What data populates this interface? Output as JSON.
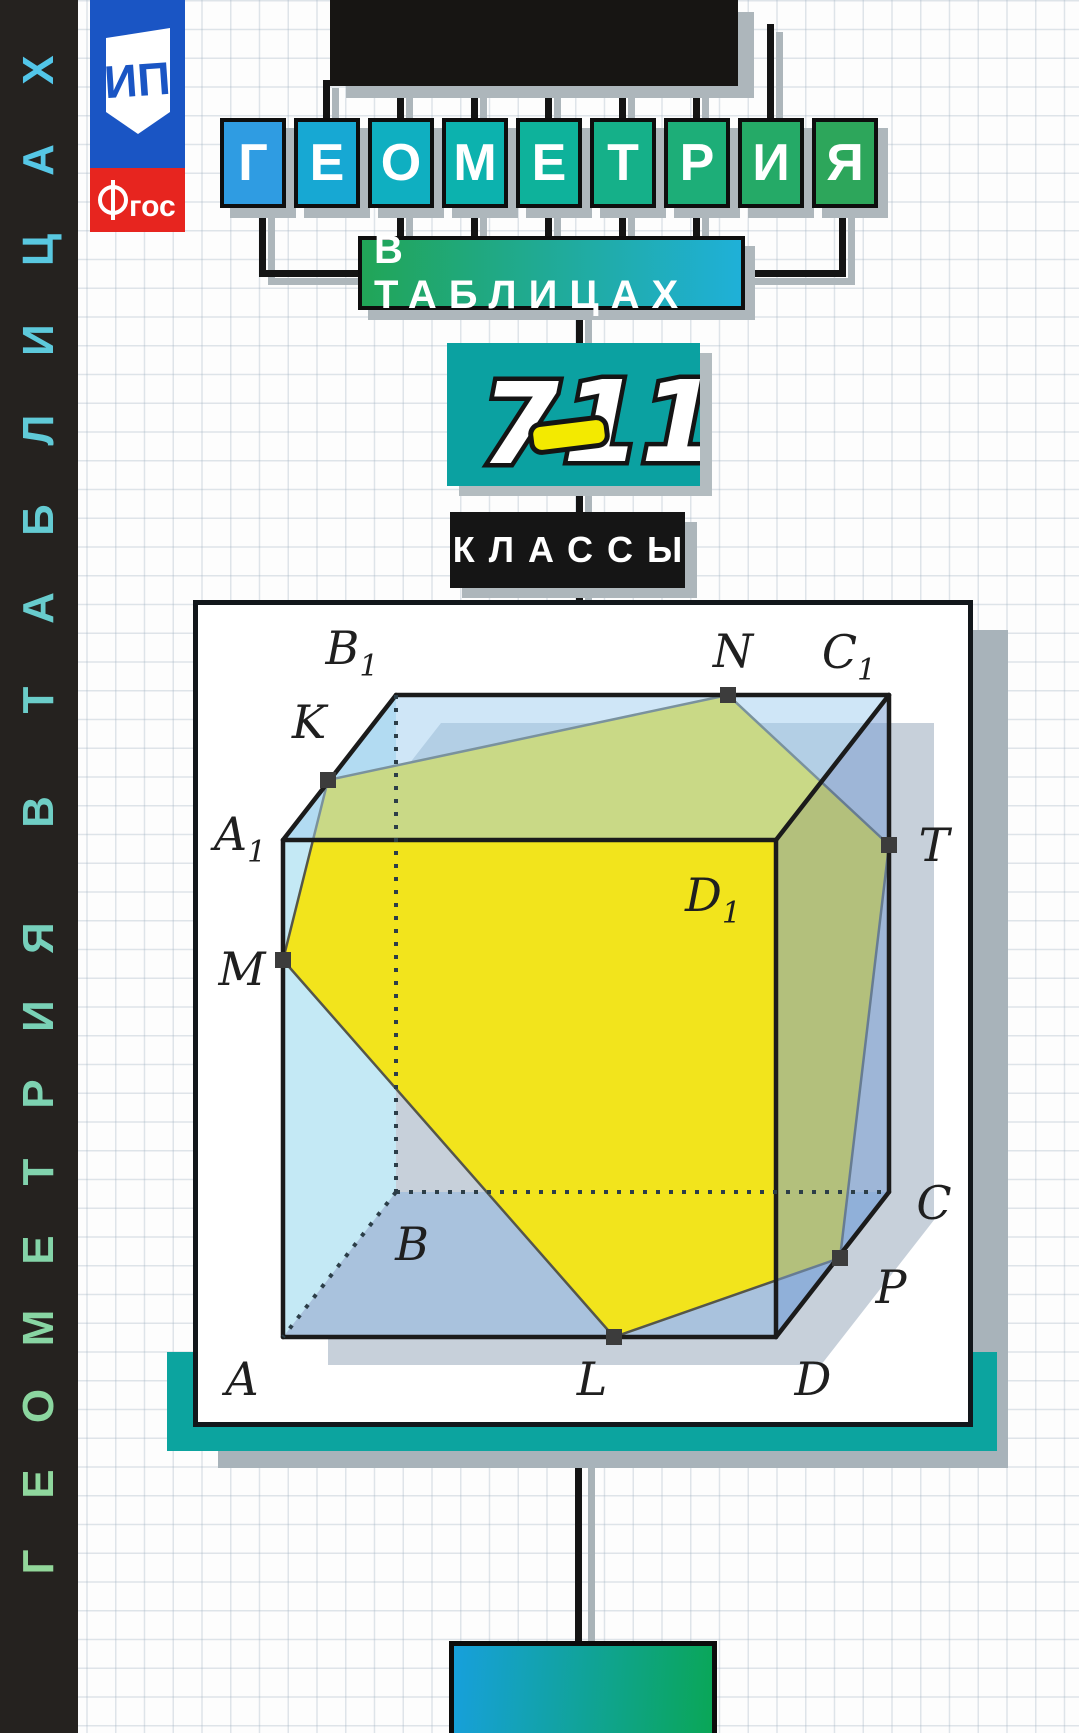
{
  "cover": {
    "title": "ГЕОМЕТРИЯ",
    "subtitle": "В ТАБЛИЦАХ",
    "classes_label": "КЛАССЫ",
    "grades": {
      "seven": "7",
      "dash": "–",
      "eleven": "11"
    },
    "spine_text": "ГЕОМЕТРИЯ В ТАБЛИЦАХ",
    "publisher_monogram": "ИП",
    "fgos_label": "гос",
    "fgos_letter_f": "Ф",
    "title_letters": [
      {
        "ch": "Г",
        "color": "#2f9ce2"
      },
      {
        "ch": "Е",
        "color": "#17a8d3"
      },
      {
        "ch": "О",
        "color": "#0fafc1"
      },
      {
        "ch": "М",
        "color": "#0cb2ae"
      },
      {
        "ch": "Е",
        "color": "#0eb29b"
      },
      {
        "ch": "Т",
        "color": "#15b089"
      },
      {
        "ch": "Р",
        "color": "#1dae78"
      },
      {
        "ch": "И",
        "color": "#25aa67"
      },
      {
        "ch": "Я",
        "color": "#2da65b"
      }
    ],
    "spine_letters": [
      {
        "ch": "Х",
        "y": 70,
        "color": "#52c6e9"
      },
      {
        "ch": "А",
        "y": 160,
        "color": "#56c7e5"
      },
      {
        "ch": "Ц",
        "y": 250,
        "color": "#59c8e0"
      },
      {
        "ch": "И",
        "y": 340,
        "color": "#5dc9db"
      },
      {
        "ch": "Л",
        "y": 430,
        "color": "#60cad7"
      },
      {
        "ch": "Б",
        "y": 520,
        "color": "#64cbd2"
      },
      {
        "ch": "А",
        "y": 608,
        "color": "#68cccd"
      },
      {
        "ch": "Т",
        "y": 700,
        "color": "#6bcdc9"
      },
      {
        "ch": "В",
        "y": 812,
        "color": "#6fcec4"
      },
      {
        "ch": "Я",
        "y": 938,
        "color": "#76d0bb"
      },
      {
        "ch": "И",
        "y": 1016,
        "color": "#79d1b6"
      },
      {
        "ch": "Р",
        "y": 1094,
        "color": "#7dd2b1"
      },
      {
        "ch": "Т",
        "y": 1172,
        "color": "#81d3ad"
      },
      {
        "ch": "Е",
        "y": 1250,
        "color": "#84d4a8"
      },
      {
        "ch": "М",
        "y": 1328,
        "color": "#88d5a3"
      },
      {
        "ch": "О",
        "y": 1406,
        "color": "#8bd69f"
      },
      {
        "ch": "Е",
        "y": 1484,
        "color": "#8fd79d"
      },
      {
        "ch": "Г",
        "y": 1562,
        "color": "#92d79a"
      }
    ]
  },
  "figure": {
    "description": "Cube ABCDA1B1C1D1 with yellow cross-section through points M K N T P L",
    "vertex_labels": [
      {
        "text": "B",
        "sub": "1",
        "x": 154,
        "y": 43
      },
      {
        "text": "N",
        "x": 535,
        "y": 46
      },
      {
        "text": "C",
        "sub": "1",
        "x": 651,
        "y": 47
      },
      {
        "text": "K",
        "x": 111,
        "y": 117
      },
      {
        "text": "A",
        "sub": "1",
        "x": 42,
        "y": 229
      },
      {
        "text": "D",
        "sub": "1",
        "x": 515,
        "y": 290
      },
      {
        "text": "T",
        "x": 736,
        "y": 240
      },
      {
        "text": "M",
        "x": 44,
        "y": 364
      },
      {
        "text": "B",
        "x": 214,
        "y": 639
      },
      {
        "text": "C",
        "x": 736,
        "y": 598
      },
      {
        "text": "P",
        "x": 693,
        "y": 682
      },
      {
        "text": "A",
        "x": 44,
        "y": 774
      },
      {
        "text": "L",
        "x": 394,
        "y": 774
      },
      {
        "text": "D",
        "x": 615,
        "y": 774
      }
    ],
    "points": [
      {
        "name": "K",
        "x": 130,
        "y": 175
      },
      {
        "name": "N",
        "x": 530,
        "y": 90
      },
      {
        "name": "T",
        "x": 691,
        "y": 240
      },
      {
        "name": "P",
        "x": 642,
        "y": 653
      },
      {
        "name": "L",
        "x": 416,
        "y": 732
      },
      {
        "name": "M",
        "x": 85,
        "y": 355
      }
    ],
    "colors": {
      "section_yellow": "#f2e41c",
      "top_face": "rgba(160,205,240,0.5)",
      "right_face": "rgba(120,160,212,0.52)",
      "left_face": "#c4e9f5",
      "bottom_face": "#a9c2dd",
      "edge": "#1b1b1b"
    }
  }
}
